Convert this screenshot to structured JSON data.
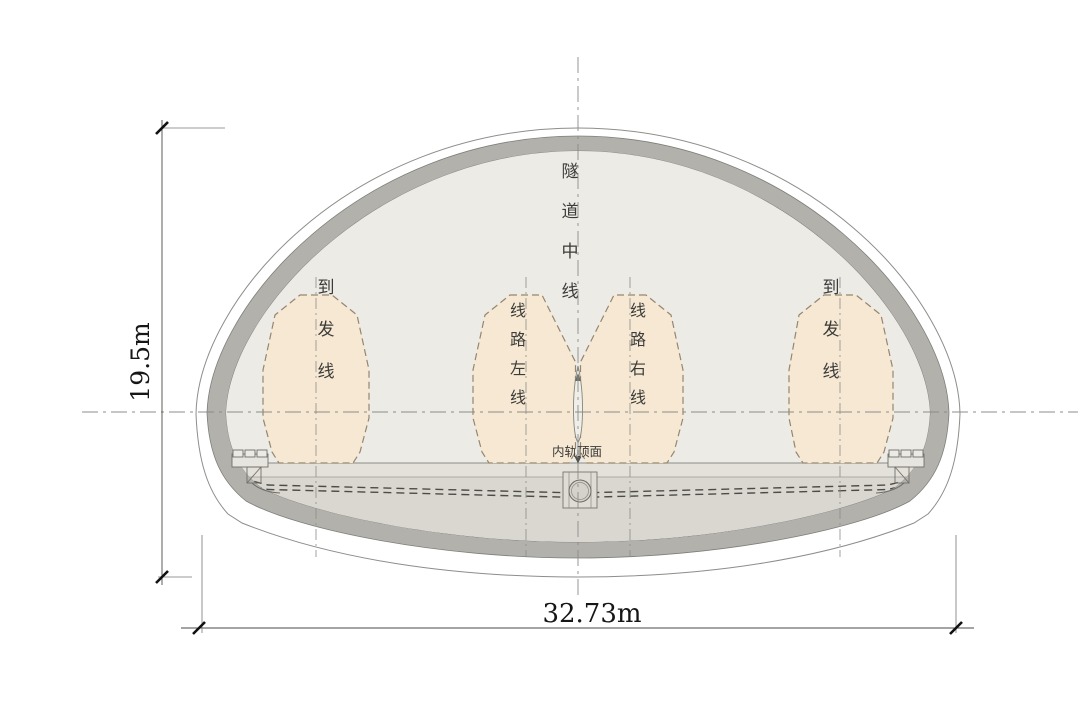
{
  "diagram": {
    "dimensions": {
      "height_label": "19.5m",
      "width_label": "32.73m"
    },
    "labels": {
      "tunnel_centerline": "隧道中线",
      "arrival_departure_left": "到发线",
      "arrival_departure_right": "到发线",
      "route_left_line": "线路左线",
      "route_right_line": "线路右线",
      "rail_top_surface": "内轨顶面"
    },
    "colors": {
      "lining": "#b3b1ac",
      "interior": "#edebe6",
      "invert_fill": "#d9d7d0",
      "floor": "#e3e1da",
      "gauge_fill": "#f6e8d2",
      "gauge_outline": "#97866e",
      "centerline": "#8c8c88",
      "outline_stroke": "#8d8d8a"
    }
  }
}
